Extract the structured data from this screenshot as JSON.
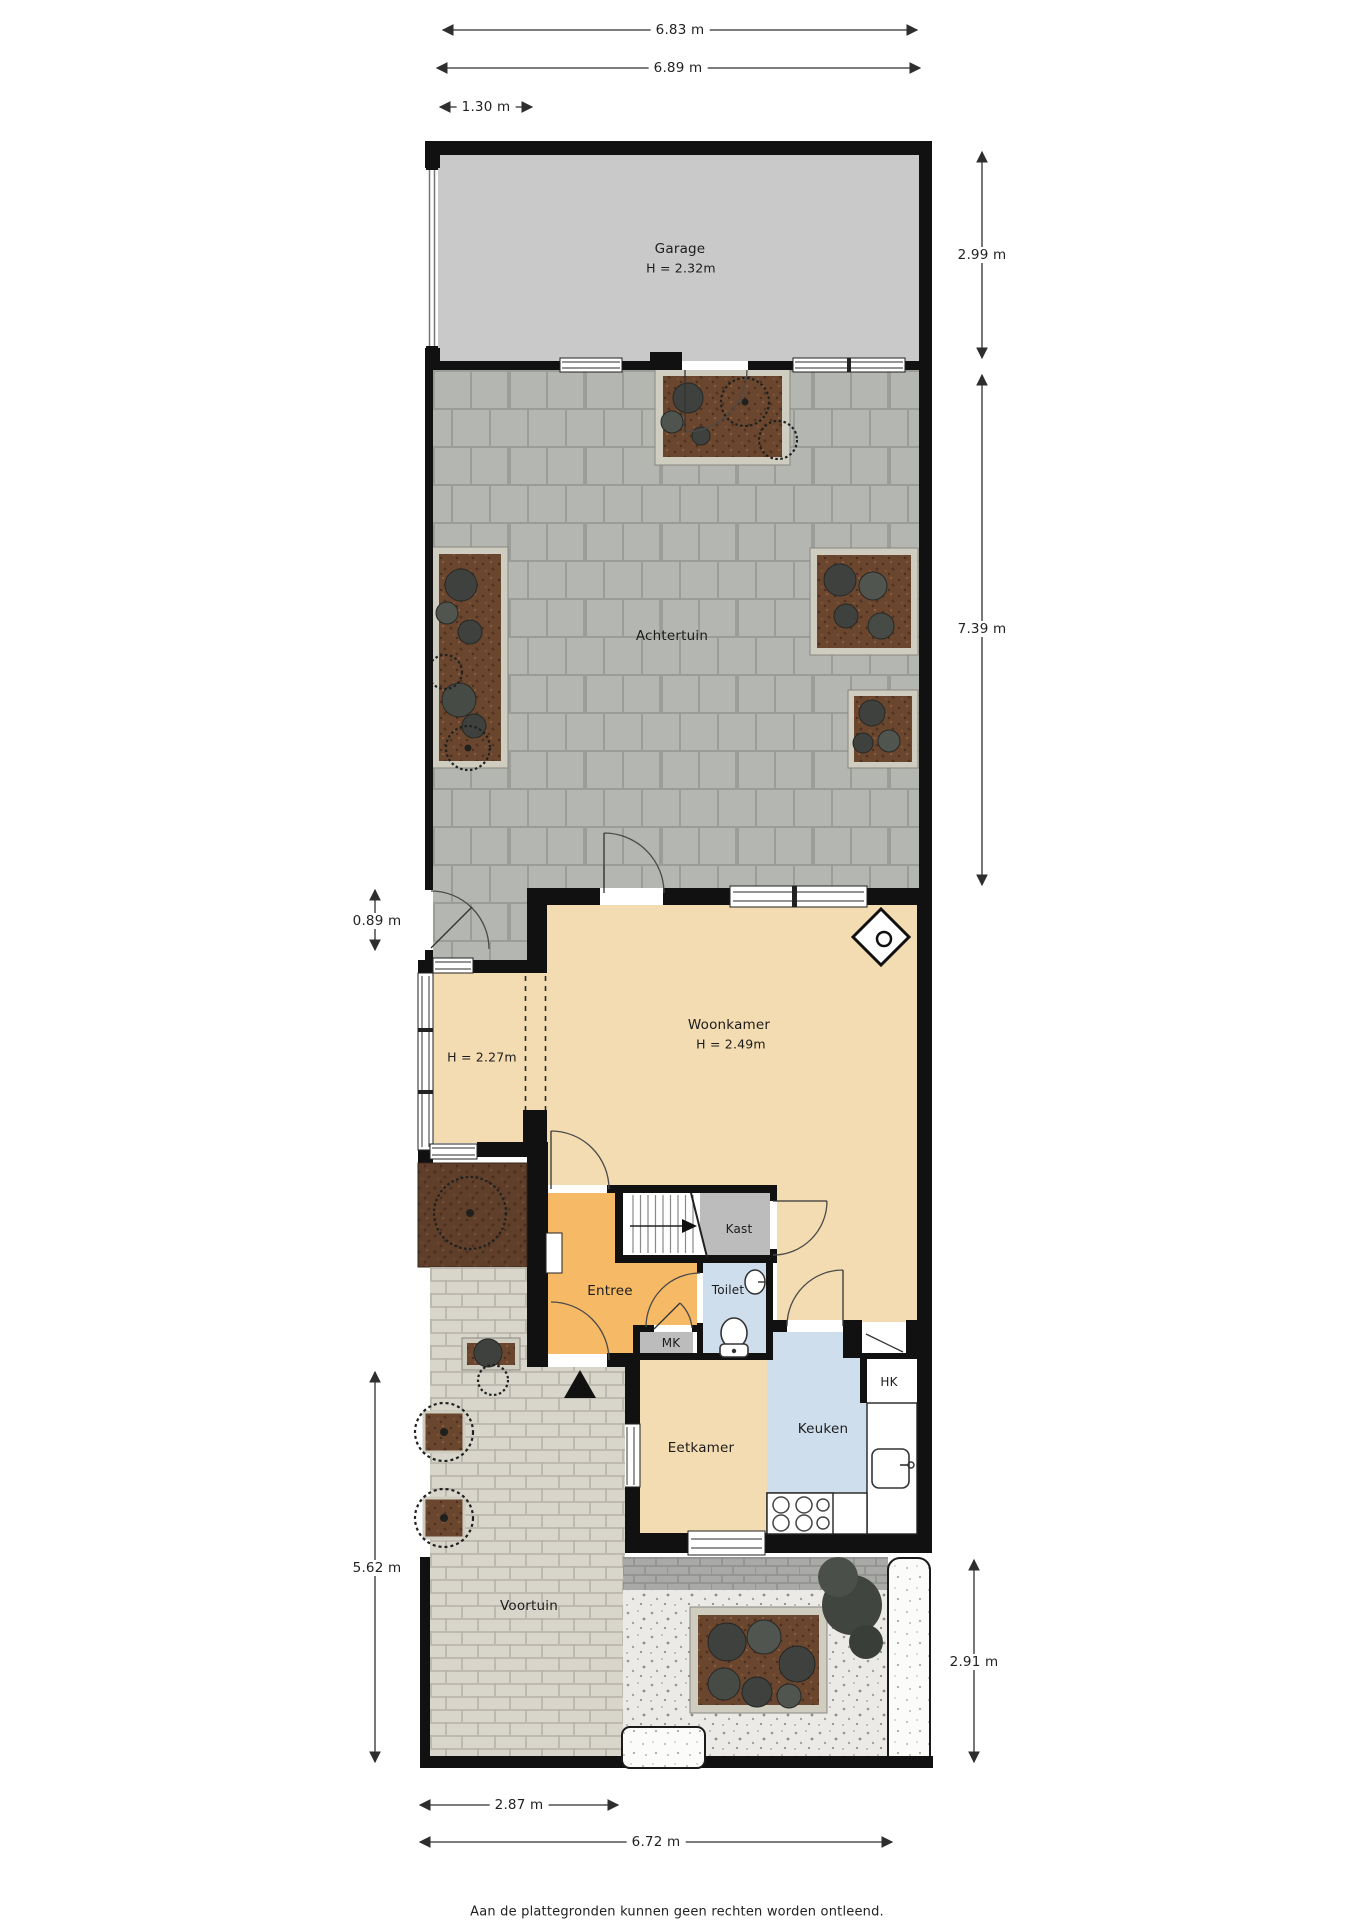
{
  "rooms": {
    "garage": {
      "label": "Garage",
      "height": "H = 2.32m"
    },
    "achtertuin": {
      "label": "Achtertuin"
    },
    "woonkamer": {
      "label": "Woonkamer",
      "height": "H = 2.49m"
    },
    "uitbouw": {
      "height": "H = 2.27m"
    },
    "entree": {
      "label": "Entree"
    },
    "kast": {
      "label": "Kast"
    },
    "toilet": {
      "label": "Toilet"
    },
    "mk": {
      "label": "MK"
    },
    "eetkamer": {
      "label": "Eetkamer"
    },
    "keuken": {
      "label": "Keuken"
    },
    "hk": {
      "label": "HK"
    },
    "voortuin": {
      "label": "Voortuin"
    }
  },
  "dimensions": {
    "top_outer": "6.83 m",
    "top_inner": "6.89 m",
    "top_left_segment": "1.30 m",
    "garage_depth": "2.99 m",
    "achtertuin_depth": "7.39 m",
    "side_gate_width": "0.89 m",
    "voortuin_depth_left": "5.62 m",
    "voortuin_depth_right": "2.91 m",
    "voortuin_width": "2.87 m",
    "total_width_bottom": "6.72 m"
  },
  "footer": {
    "disclaimer": "Aan de plattegronden kunnen geen rechten worden ontleend."
  },
  "colors": {
    "wall": "#111111",
    "garage_floor": "#c9c9c9",
    "terrace_tile": "#b4b6b1",
    "living_floor": "#f3dcb1",
    "hall_floor": "#f6b966",
    "kitchen_floor": "#cfdeed",
    "closet_floor": "#bcbcbc",
    "front_brick": "#d8d5cb",
    "planter_soil": "#6b462f",
    "shrub": "#3e413d",
    "gravel": "#eceae6"
  }
}
